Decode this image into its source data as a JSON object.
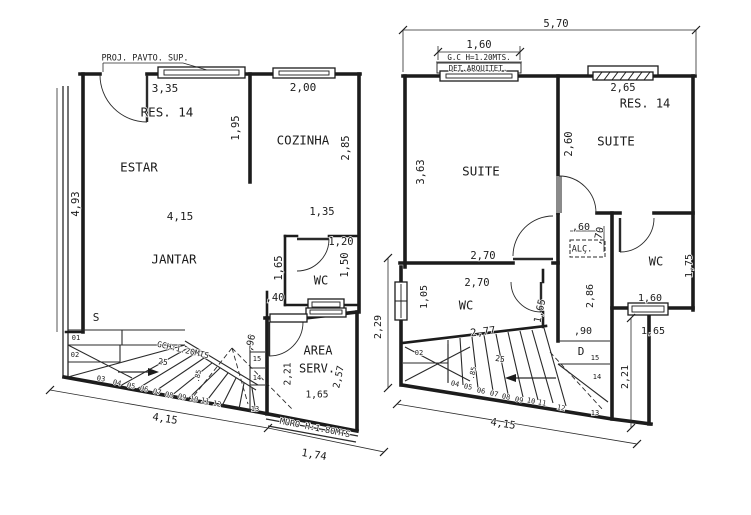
{
  "colors": {
    "line": "#1c1c1c",
    "background": "#ffffff",
    "door_leaf": "#8a8a8a"
  },
  "labels": [
    {
      "name": "note-proj-pavto-sup",
      "text": "PROJ. PAVTO. SUP.",
      "x": 145,
      "y": 58,
      "r": 0,
      "fs": 8.5
    },
    {
      "name": "dim-estar-top",
      "text": "3,35",
      "x": 165,
      "y": 89,
      "r": 0,
      "fs": 11
    },
    {
      "name": "room-res14-left",
      "text": "RES. 14",
      "x": 167,
      "y": 113,
      "r": 0,
      "fs": 12.5
    },
    {
      "name": "dim-wall-195",
      "text": "1,95",
      "x": 236,
      "y": 128,
      "r": -90,
      "fs": 10.5
    },
    {
      "name": "dim-cozinha-top",
      "text": "2,00",
      "x": 303,
      "y": 88,
      "r": 0,
      "fs": 11
    },
    {
      "name": "room-cozinha",
      "text": "COZINHA",
      "x": 303,
      "y": 141,
      "r": 0,
      "fs": 12.5
    },
    {
      "name": "dim-cozinha-right",
      "text": "2,85",
      "x": 346,
      "y": 148,
      "r": -90,
      "fs": 10.5
    },
    {
      "name": "room-estar",
      "text": "ESTAR",
      "x": 139,
      "y": 168,
      "r": 0,
      "fs": 12.5
    },
    {
      "name": "dim-left-height",
      "text": "4,93",
      "x": 76,
      "y": 204,
      "r": -90,
      "fs": 10.5
    },
    {
      "name": "dim-jantar-width",
      "text": "4,15",
      "x": 180,
      "y": 217,
      "r": 0,
      "fs": 11
    },
    {
      "name": "dim-passage-135",
      "text": "1,35",
      "x": 322,
      "y": 212,
      "r": 0,
      "fs": 10.5
    },
    {
      "name": "room-jantar",
      "text": "JANTAR",
      "x": 174,
      "y": 260,
      "r": 0,
      "fs": 12.5
    },
    {
      "name": "dim-wc-120",
      "text": "1,20",
      "x": 341,
      "y": 242,
      "r": 0,
      "fs": 10.5
    },
    {
      "name": "dim-wc-165",
      "text": "1,65",
      "x": 279,
      "y": 268,
      "r": -90,
      "fs": 10.5
    },
    {
      "name": "room-wc-left",
      "text": "WC",
      "x": 321,
      "y": 281,
      "r": 0,
      "fs": 12
    },
    {
      "name": "dim-wc-150",
      "text": "1,50",
      "x": 345,
      "y": 265,
      "r": -90,
      "fs": 10.5
    },
    {
      "name": "dim-stub-40",
      "text": ",40",
      "x": 275,
      "y": 298,
      "r": 0,
      "fs": 10.5
    },
    {
      "name": "stair-up-label",
      "text": "S",
      "x": 96,
      "y": 318,
      "r": 0,
      "fs": 11
    },
    {
      "name": "tread-01",
      "text": "01",
      "x": 76,
      "y": 338,
      "r": 0,
      "fs": 7
    },
    {
      "name": "tread-02",
      "text": "02",
      "x": 75,
      "y": 355,
      "r": 0,
      "fs": 7
    },
    {
      "name": "tread-03",
      "text": "03",
      "x": 101,
      "y": 379,
      "r": 8,
      "fs": 7
    },
    {
      "name": "note-gch",
      "text": "GCH:1.20MTS",
      "x": 183,
      "y": 350,
      "r": 13,
      "fs": 8
    },
    {
      "name": "tread-depth-25",
      "text": "25",
      "x": 163,
      "y": 362,
      "r": 8,
      "fs": 8
    },
    {
      "name": "tread-width-85",
      "text": ".85",
      "x": 198,
      "y": 376,
      "r": -78,
      "fs": 7
    },
    {
      "name": "tread-04",
      "text": "04",
      "x": 117,
      "y": 383,
      "r": 12,
      "fs": 7
    },
    {
      "name": "tread-05",
      "text": "05",
      "x": 131,
      "y": 386,
      "r": 12,
      "fs": 7
    },
    {
      "name": "tread-06",
      "text": "06",
      "x": 144,
      "y": 389,
      "r": 12,
      "fs": 7
    },
    {
      "name": "tread-07",
      "text": "07",
      "x": 157,
      "y": 392,
      "r": 12,
      "fs": 7
    },
    {
      "name": "tread-08",
      "text": "08",
      "x": 169,
      "y": 395,
      "r": 12,
      "fs": 7
    },
    {
      "name": "tread-09",
      "text": "09",
      "x": 182,
      "y": 397,
      "r": 12,
      "fs": 7
    },
    {
      "name": "tread-10",
      "text": "10",
      "x": 194,
      "y": 399,
      "r": 12,
      "fs": 7
    },
    {
      "name": "tread-11",
      "text": "11",
      "x": 205,
      "y": 401,
      "r": 12,
      "fs": 7
    },
    {
      "name": "tread-12",
      "text": "12",
      "x": 217,
      "y": 404,
      "r": 12,
      "fs": 7
    },
    {
      "name": "tread-15-left",
      "text": "15",
      "x": 257,
      "y": 359,
      "r": 0,
      "fs": 7
    },
    {
      "name": "tread-14-left",
      "text": "14",
      "x": 257,
      "y": 378,
      "r": 0,
      "fs": 7
    },
    {
      "name": "tread-13-left",
      "text": "13",
      "x": 255,
      "y": 409,
      "r": 0,
      "fs": 7
    },
    {
      "name": "dim-landing-96",
      "text": ",96",
      "x": 251,
      "y": 343,
      "r": -78,
      "fs": 9.5
    },
    {
      "name": "dim-areaserv-left",
      "text": "2,21",
      "x": 288,
      "y": 374,
      "r": -90,
      "fs": 9.5
    },
    {
      "name": "room-area",
      "text": "AREA",
      "x": 318,
      "y": 351,
      "r": 0,
      "fs": 12
    },
    {
      "name": "room-serv",
      "text": "SERV.",
      "x": 317,
      "y": 369,
      "r": 0,
      "fs": 12
    },
    {
      "name": "dim-areaserv-right",
      "text": "2,57",
      "x": 339,
      "y": 377,
      "r": -78,
      "fs": 9.5
    },
    {
      "name": "dim-areaserv-bottom",
      "text": "1,65",
      "x": 317,
      "y": 395,
      "r": 0,
      "fs": 9.5
    },
    {
      "name": "note-muro",
      "text": "MURO H:1.80MTS",
      "x": 315,
      "y": 428,
      "r": 11,
      "fs": 8.5
    },
    {
      "name": "dim-muro-174",
      "text": "1,74",
      "x": 314,
      "y": 455,
      "r": 10,
      "fs": 10.5
    },
    {
      "name": "dim-bottom-left-415",
      "text": "4,15",
      "x": 165,
      "y": 419,
      "r": 9,
      "fs": 10.5
    },
    {
      "name": "dim-overall-570",
      "text": "5,70",
      "x": 556,
      "y": 24,
      "r": 0,
      "fs": 10.5
    },
    {
      "name": "dim-gc-160",
      "text": "1,60",
      "x": 479,
      "y": 45,
      "r": 0,
      "fs": 10.5
    },
    {
      "name": "note-gc",
      "text": "G.C H=1.20MTS.",
      "x": 479,
      "y": 58,
      "r": 0,
      "fs": 7.5
    },
    {
      "name": "note-det-arquitet",
      "text": "DET.ARQUITET.",
      "x": 478,
      "y": 69,
      "r": 0,
      "fs": 7.5
    },
    {
      "name": "dim-suite2-window",
      "text": "2,65",
      "x": 623,
      "y": 88,
      "r": 0,
      "fs": 10.5
    },
    {
      "name": "room-res14-right",
      "text": "RES. 14",
      "x": 645,
      "y": 104,
      "r": 0,
      "fs": 12
    },
    {
      "name": "dim-suite1-left",
      "text": "3,63",
      "x": 421,
      "y": 172,
      "r": -90,
      "fs": 10.5
    },
    {
      "name": "room-suite-left",
      "text": "SUITE",
      "x": 481,
      "y": 172,
      "r": 0,
      "fs": 12.5
    },
    {
      "name": "dim-suite2-left",
      "text": "2,60",
      "x": 569,
      "y": 144,
      "r": -90,
      "fs": 10.5
    },
    {
      "name": "room-suite-right",
      "text": "SUITE",
      "x": 616,
      "y": 142,
      "r": 0,
      "fs": 12.5
    },
    {
      "name": "dim-suite1-bottom",
      "text": "2,70",
      "x": 483,
      "y": 256,
      "r": 0,
      "fs": 10.5
    },
    {
      "name": "dim-wcbl-top",
      "text": "2,70",
      "x": 477,
      "y": 283,
      "r": 0,
      "fs": 10.5
    },
    {
      "name": "dim-wcbl-window",
      "text": "1,05",
      "x": 424,
      "y": 297,
      "r": -90,
      "fs": 10
    },
    {
      "name": "room-wc-bottomleft",
      "text": "WC",
      "x": 466,
      "y": 306,
      "r": 0,
      "fs": 12
    },
    {
      "name": "dim-alc-60",
      "text": ",60",
      "x": 581,
      "y": 227,
      "r": 0,
      "fs": 10
    },
    {
      "name": "dim-alc-70",
      "text": ",70",
      "x": 599,
      "y": 236,
      "r": -78,
      "fs": 10
    },
    {
      "name": "note-alc",
      "text": "ALÇ.",
      "x": 582,
      "y": 249,
      "r": 0,
      "fs": 8.5
    },
    {
      "name": "dim-hall-286",
      "text": "2,86",
      "x": 590,
      "y": 296,
      "r": -90,
      "fs": 10
    },
    {
      "name": "room-wc-right",
      "text": "WC",
      "x": 656,
      "y": 262,
      "r": 0,
      "fs": 12
    },
    {
      "name": "dim-wcr-right",
      "text": "1,75",
      "x": 689,
      "y": 266,
      "r": -90,
      "fs": 10
    },
    {
      "name": "dim-wcr-window",
      "text": "1,60",
      "x": 650,
      "y": 298,
      "r": 0,
      "fs": 10
    },
    {
      "name": "dim-wcr-below",
      "text": "1,65",
      "x": 653,
      "y": 331,
      "r": 0,
      "fs": 10
    },
    {
      "name": "dim-wcbl-right",
      "text": "1,65",
      "x": 540,
      "y": 311,
      "r": -78,
      "fs": 10
    },
    {
      "name": "dim-wcbl-bottom",
      "text": "2,77",
      "x": 483,
      "y": 332,
      "r": -7,
      "fs": 10.5
    },
    {
      "name": "dim-landing-90",
      "text": ",90",
      "x": 583,
      "y": 331,
      "r": 0,
      "fs": 10
    },
    {
      "name": "stair-down-label",
      "text": "D",
      "x": 581,
      "y": 352,
      "r": 0,
      "fs": 11
    },
    {
      "name": "tread-15-right",
      "text": "15",
      "x": 595,
      "y": 358,
      "r": 0,
      "fs": 7
    },
    {
      "name": "tread-14-right",
      "text": "14",
      "x": 597,
      "y": 377,
      "r": 0,
      "fs": 7
    },
    {
      "name": "tread-13-right",
      "text": "13",
      "x": 595,
      "y": 413,
      "r": 0,
      "fs": 7
    },
    {
      "name": "tread-02-right",
      "text": "02",
      "x": 419,
      "y": 353,
      "r": 0,
      "fs": 7
    },
    {
      "name": "tread-depth-25-right",
      "text": "25",
      "x": 500,
      "y": 359,
      "r": 8,
      "fs": 8
    },
    {
      "name": "tread-width-85-right",
      "text": ".85",
      "x": 473,
      "y": 373,
      "r": -78,
      "fs": 7
    },
    {
      "name": "tread-04-right",
      "text": "04",
      "x": 455,
      "y": 384,
      "r": 12,
      "fs": 7
    },
    {
      "name": "tread-05-right",
      "text": "05",
      "x": 468,
      "y": 387,
      "r": 12,
      "fs": 7
    },
    {
      "name": "tread-06-right",
      "text": "06",
      "x": 481,
      "y": 391,
      "r": 12,
      "fs": 7
    },
    {
      "name": "tread-07-right",
      "text": "07",
      "x": 494,
      "y": 394,
      "r": 12,
      "fs": 7
    },
    {
      "name": "tread-08-right",
      "text": "08",
      "x": 506,
      "y": 397,
      "r": 12,
      "fs": 7
    },
    {
      "name": "tread-09-right",
      "text": "09",
      "x": 519,
      "y": 400,
      "r": 12,
      "fs": 7
    },
    {
      "name": "tread-10-right",
      "text": "10",
      "x": 531,
      "y": 401,
      "r": 12,
      "fs": 7
    },
    {
      "name": "tread-11-right",
      "text": "11",
      "x": 542,
      "y": 403,
      "r": 12,
      "fs": 7
    },
    {
      "name": "tread-12-right",
      "text": "12",
      "x": 561,
      "y": 408,
      "r": 12,
      "fs": 7
    },
    {
      "name": "dim-bottom-right-415",
      "text": "4,15",
      "x": 503,
      "y": 424,
      "r": 9,
      "fs": 10.5
    },
    {
      "name": "dim-terrace-221",
      "text": "2,21",
      "x": 625,
      "y": 377,
      "r": -90,
      "fs": 10
    },
    {
      "name": "dim-between-229",
      "text": "2,29",
      "x": 378,
      "y": 327,
      "r": -90,
      "fs": 10
    }
  ]
}
